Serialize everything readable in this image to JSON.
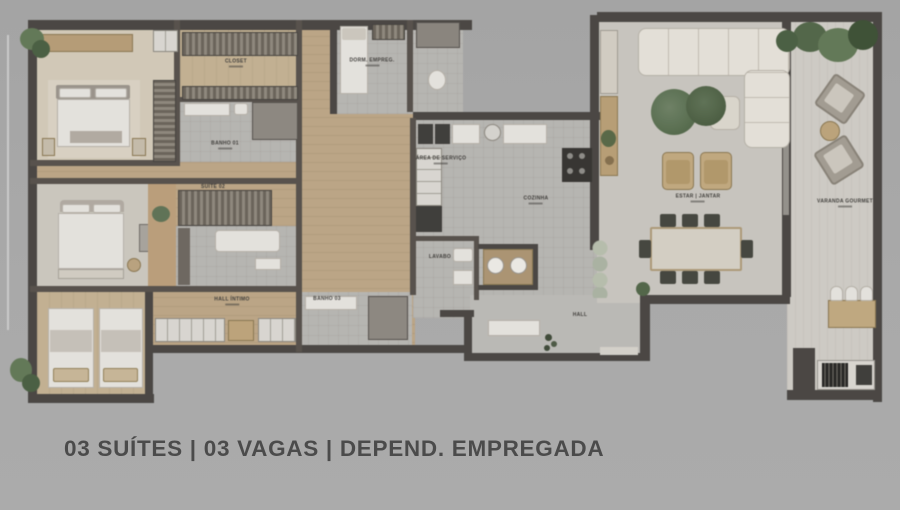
{
  "page": {
    "background_color": "#a8a8a8",
    "caption_color": "#4b4b4b"
  },
  "caption": {
    "text": "03 SUÍTES | 03 VAGAS | DEPEND. EMPREGADA"
  },
  "floorplan": {
    "type": "apartment floor plan (top-down render)",
    "room_labels": {
      "closet": "CLOSET",
      "banho_suite1": "BANHO 01",
      "suite2": "SUÍTE 02",
      "hall_intimo": "HALL ÍNTIMO",
      "banho3": "BANHO 03",
      "dorm_empregada": "DORM. EMPREG.",
      "area_servico": "ÁREA DE SERVIÇO",
      "cozinha": "COZINHA",
      "lavabo": "LAVABO",
      "hall_entrada": "HALL",
      "estar_jantar": "ESTAR | JANTAR",
      "varanda": "VARANDA GOURMET"
    },
    "colors": {
      "walls": "#494541",
      "wood_floor": "#c2a67e",
      "gray_floor": "#b9b7b2",
      "living_floor": "#cbc7bf",
      "sofa": "#e8e3d9",
      "greenery": "#5c7450",
      "tan_furniture": "#c4a471"
    }
  }
}
